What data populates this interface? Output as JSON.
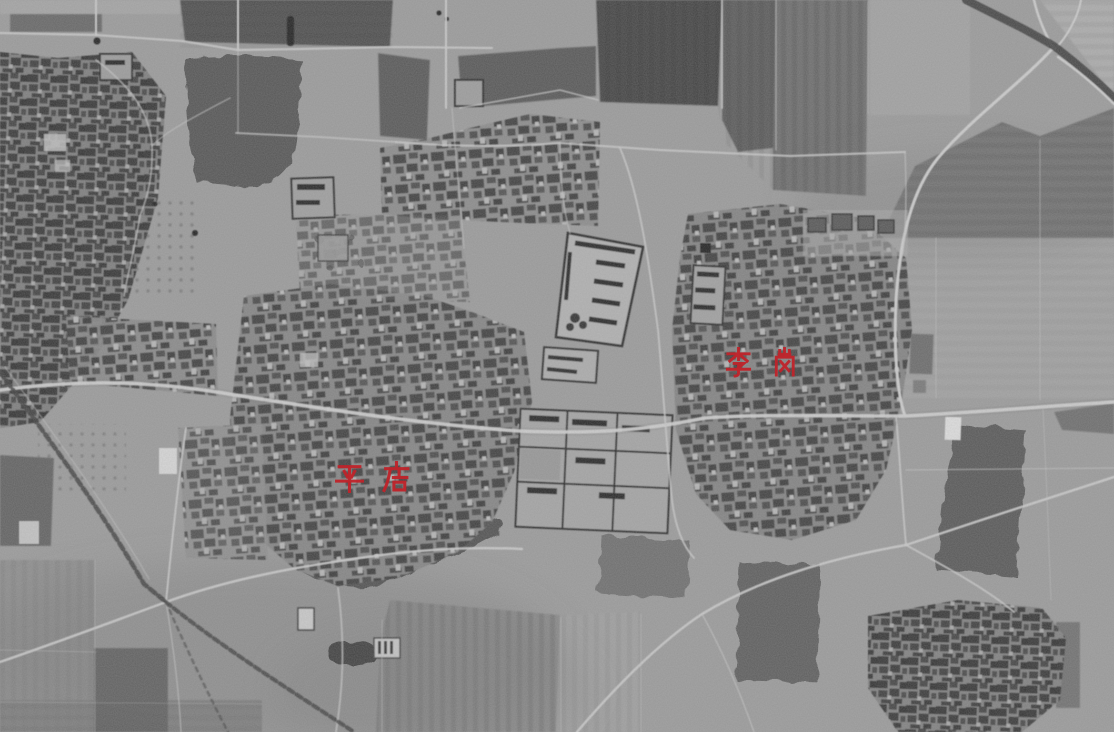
{
  "image": {
    "kind": "black-and-white aerial photograph",
    "content": "grayscale aerial view of farmland, dirt roads, ponds, tree lines and dense village house clusters",
    "label_language": "Chinese"
  },
  "labels": [
    {
      "id": "pingdian",
      "text": "平店",
      "chars": [
        "平",
        "店"
      ],
      "color": "#bf242b"
    },
    {
      "id": "ligang",
      "text": "李岗",
      "chars": [
        "李",
        "岗"
      ],
      "color": "#bf242b"
    }
  ]
}
